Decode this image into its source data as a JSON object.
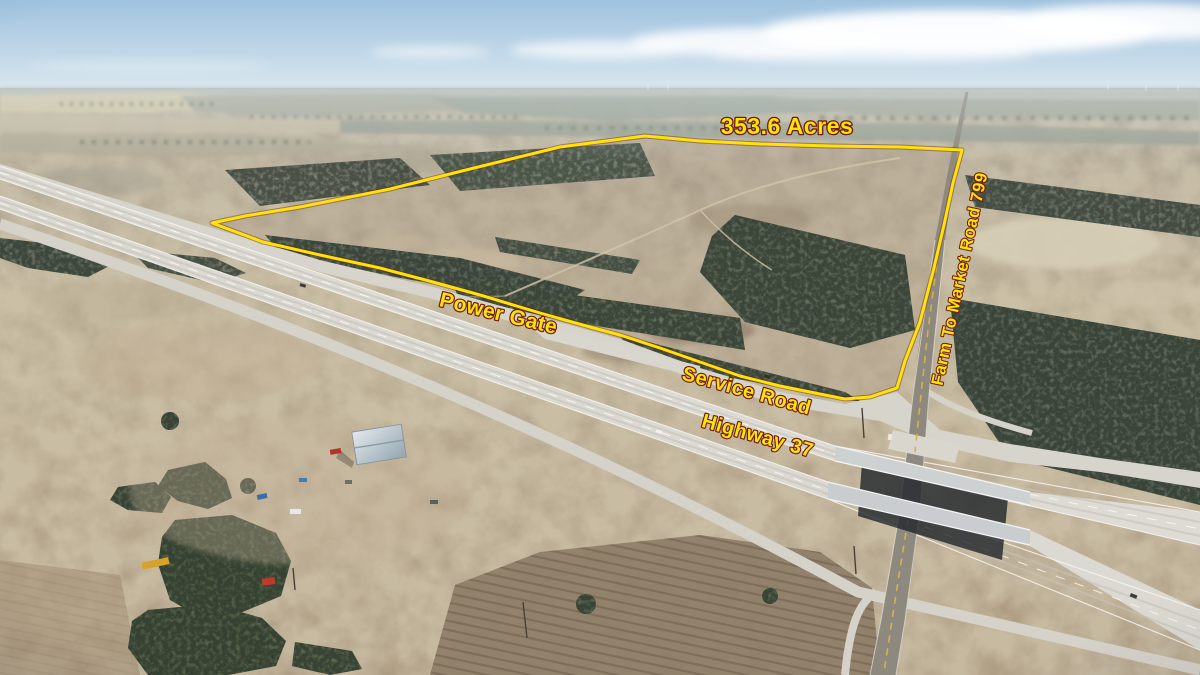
{
  "annotations": {
    "acreage_label": "353.6 Acres",
    "power_gate_label": "Power Gate",
    "service_road_label": "Service Road",
    "highway_label": "Highway 37",
    "fm_road_label": "Farm To Market Road 799"
  },
  "colors": {
    "boundary_yellow": "#FFE206",
    "label_fill": "#FFE206",
    "label_outline": "#6E1A0C"
  }
}
